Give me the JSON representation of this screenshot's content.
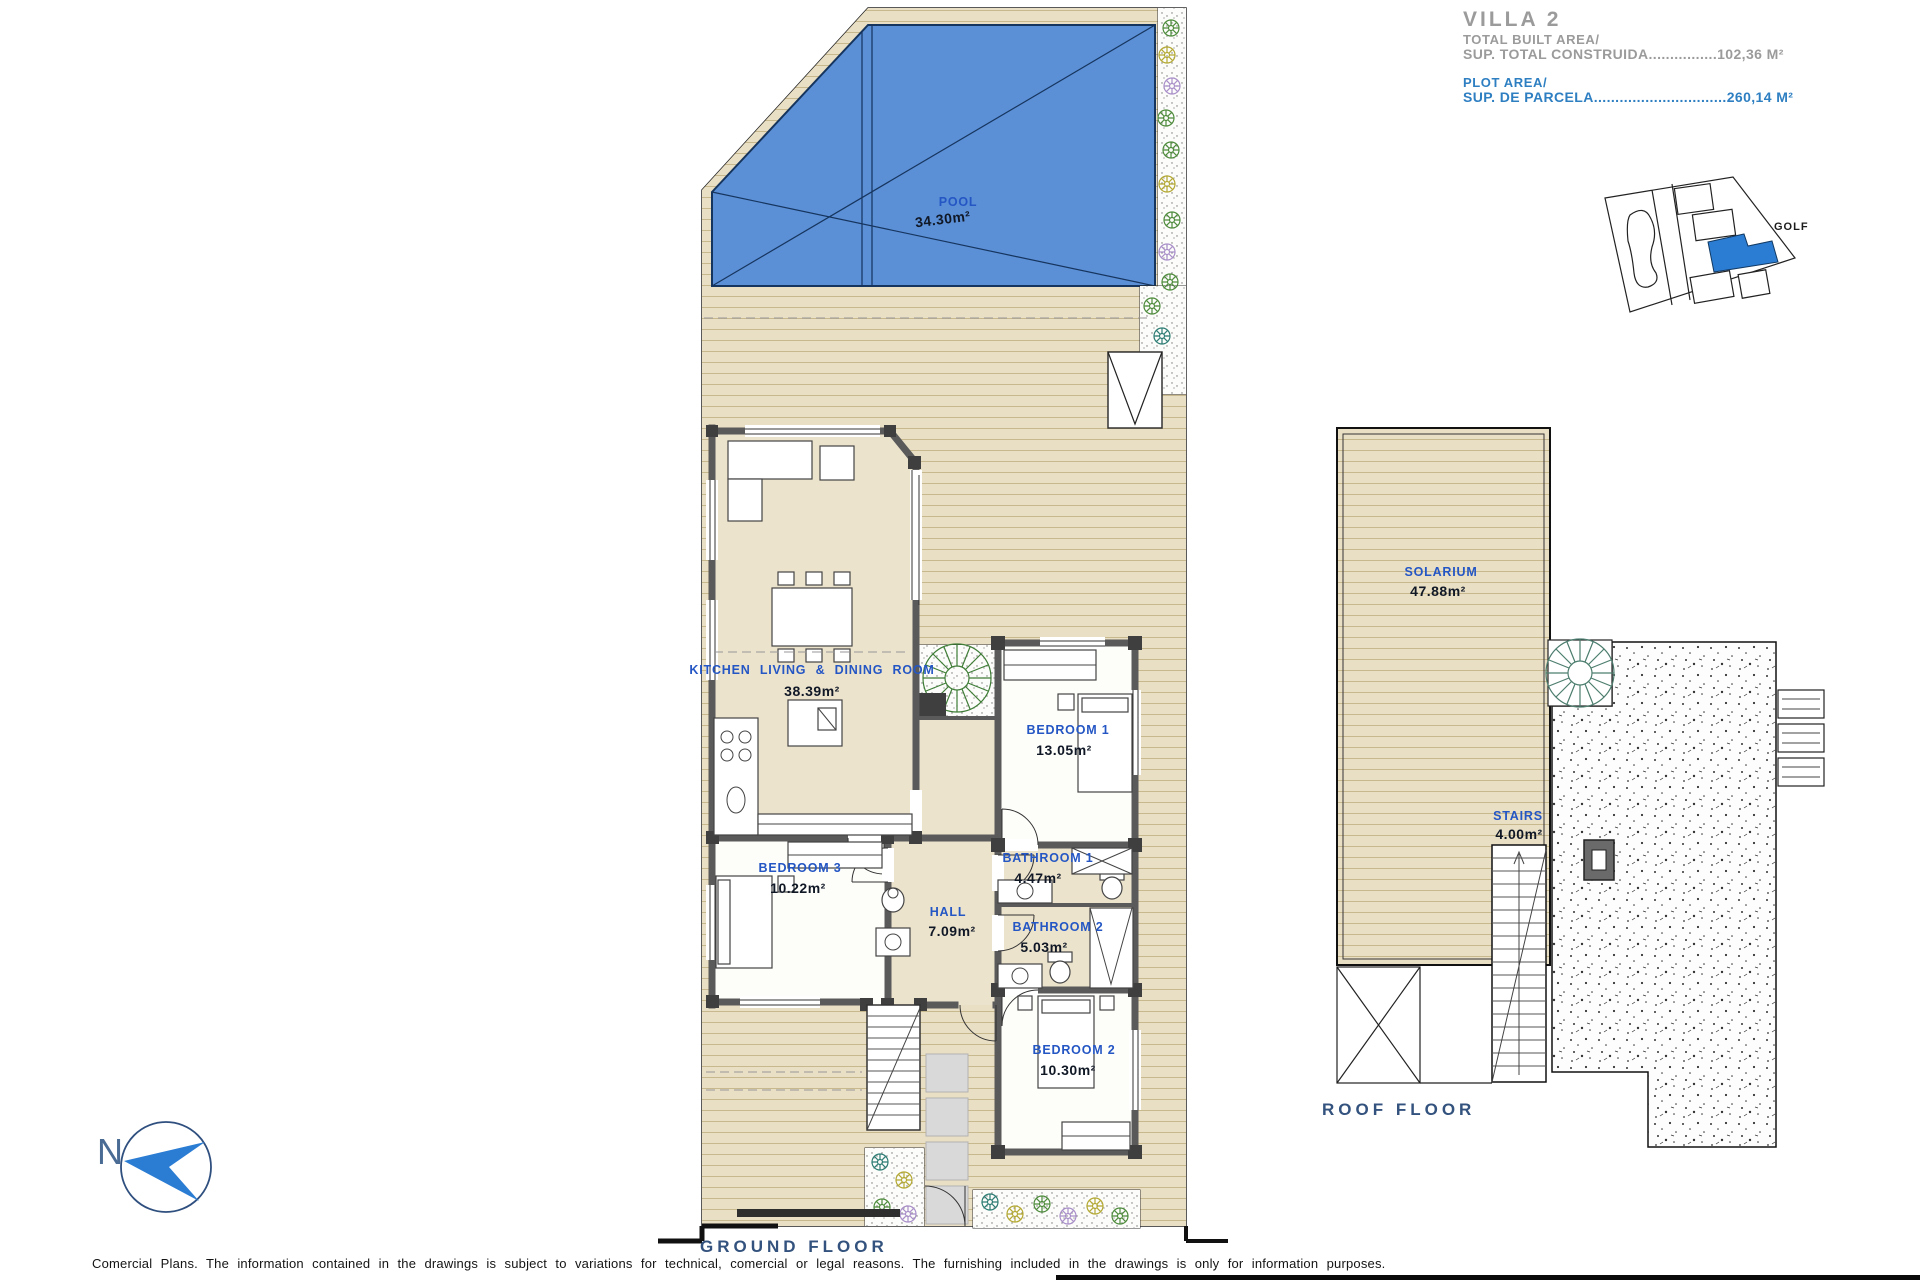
{
  "header": {
    "villa_title": "VILLA 2",
    "total_built_area_label": "TOTAL BUILT AREA/",
    "total_built_area_line": "SUP. TOTAL CONSTRUIDA................102,36 M²",
    "plot_area_label": "PLOT AREA/",
    "plot_area_line": "SUP. DE PARCELA...............................260,14 M²"
  },
  "site_map": {
    "golf_label": "GOLF"
  },
  "ground_floor": {
    "title": "GROUND FLOOR",
    "pool": {
      "name": "POOL",
      "area": "34.30m²"
    },
    "rooms": {
      "kitchen_living_dining": {
        "name": "KITCHEN LIVING & DINING ROOM",
        "area": "38.39m²"
      },
      "bedroom_1": {
        "name": "BEDROOM 1",
        "area": "13.05m²"
      },
      "bedroom_2": {
        "name": "BEDROOM 2",
        "area": "10.30m²"
      },
      "bedroom_3": {
        "name": "BEDROOM 3",
        "area": "10.22m²"
      },
      "bathroom_1": {
        "name": "BATHROOM 1",
        "area": "4.47m²"
      },
      "bathroom_2": {
        "name": "BATHROOM 2",
        "area": "5.03m²"
      },
      "hall": {
        "name": "HALL",
        "area": "7.09m²"
      }
    }
  },
  "roof_floor": {
    "title": "ROOF FLOOR",
    "rooms": {
      "solarium": {
        "name": "SOLARIUM",
        "area": "47.88m²"
      },
      "stairs": {
        "name": "STAIRS",
        "area": "4.00m²"
      }
    }
  },
  "compass": {
    "north_label": "N"
  },
  "footer": {
    "disclaimer": "Comercial Plans. The information contained in the drawings is subject to variations for technical, comercial or legal reasons. The furnishing included in the drawings is only for information purposes."
  },
  "colors": {
    "label_blue": "#2456c4",
    "area_dark": "#101826",
    "title_gray": "#9b9b9b",
    "title_blue": "#2e7fc2",
    "floor_title_blue": "#33527d",
    "pool_fill": "#5b8fd6",
    "pool_line": "#16355e",
    "deck_fill": "#e9dfc4",
    "deck_line": "#c8b88d",
    "wall_gray": "#5a5a5a",
    "site_highlight": "#2b7cd3",
    "compass_blue": "#2b7cd3"
  }
}
